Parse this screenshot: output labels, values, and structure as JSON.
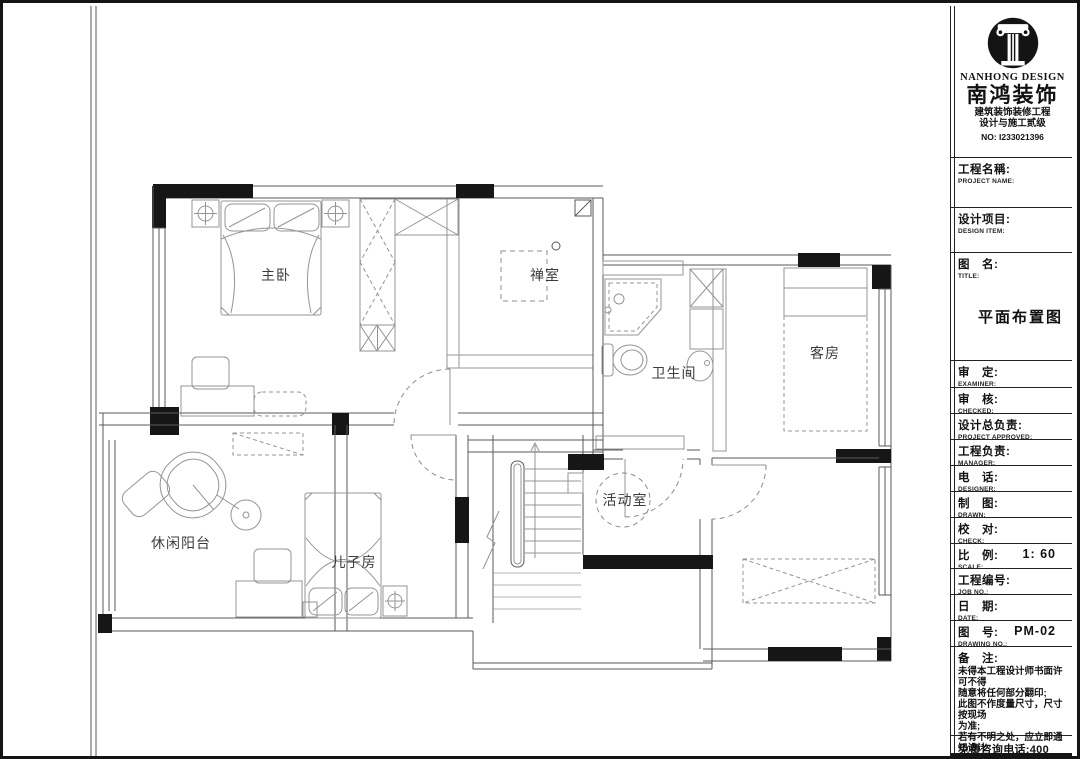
{
  "brand": {
    "name_en": "NANHONG DESIGN",
    "name_cn": "南鸿装饰",
    "tagline1": "建筑装饰装修工程",
    "tagline2": "设计与施工贰级",
    "cert_no": "NO: I233021396"
  },
  "fields": [
    {
      "cn": "工程名稱:",
      "en": "PROJECT NAME:",
      "value": ""
    },
    {
      "cn": "设计项目:",
      "en": "DESIGN ITEM:",
      "value": ""
    },
    {
      "cn": "图　名:",
      "en": "TITLE:",
      "value": "平面布置图"
    },
    {
      "cn": "审　定:",
      "en": "EXAMINER:",
      "value": ""
    },
    {
      "cn": "审　核:",
      "en": "CHECKED:",
      "value": ""
    },
    {
      "cn": "设计总负责:",
      "en": "PROJECT APPROVED:",
      "value": ""
    },
    {
      "cn": "工程负责:",
      "en": "MANAGER:",
      "value": ""
    },
    {
      "cn": "电　话:",
      "en": "DESIGNER:",
      "value": ""
    },
    {
      "cn": "制　图:",
      "en": "DRAWN:",
      "value": ""
    },
    {
      "cn": "校　对:",
      "en": "CHECK:",
      "value": ""
    },
    {
      "cn": "比　例:",
      "en": "SCALE:",
      "value": "1: 60"
    },
    {
      "cn": "工程编号:",
      "en": "JOB NO.:",
      "value": ""
    },
    {
      "cn": "日　期:",
      "en": "DATE:",
      "value": ""
    },
    {
      "cn": "图　号:",
      "en": "DRAWING NO.:",
      "value": "PM-02"
    }
  ],
  "notes": {
    "label": "备　注:",
    "lines": [
      "未得本工程设计师书面许可不得",
      "随意将任何部分翻印;",
      "此图不作度量尺寸，尺寸按现场",
      "为准;",
      "若有不明之处，应立即通知设计",
      "师。"
    ],
    "tiny": "本单位保留设计图纸最终解释权。",
    "phone": "免费咨询电话:400 8383 168"
  },
  "rooms": {
    "master": "主卧",
    "meditation": "禅室",
    "bathroom": "卫生间",
    "guest": "客房",
    "activity": "活动室",
    "son": "儿子房",
    "balcony": "休闲阳台"
  }
}
